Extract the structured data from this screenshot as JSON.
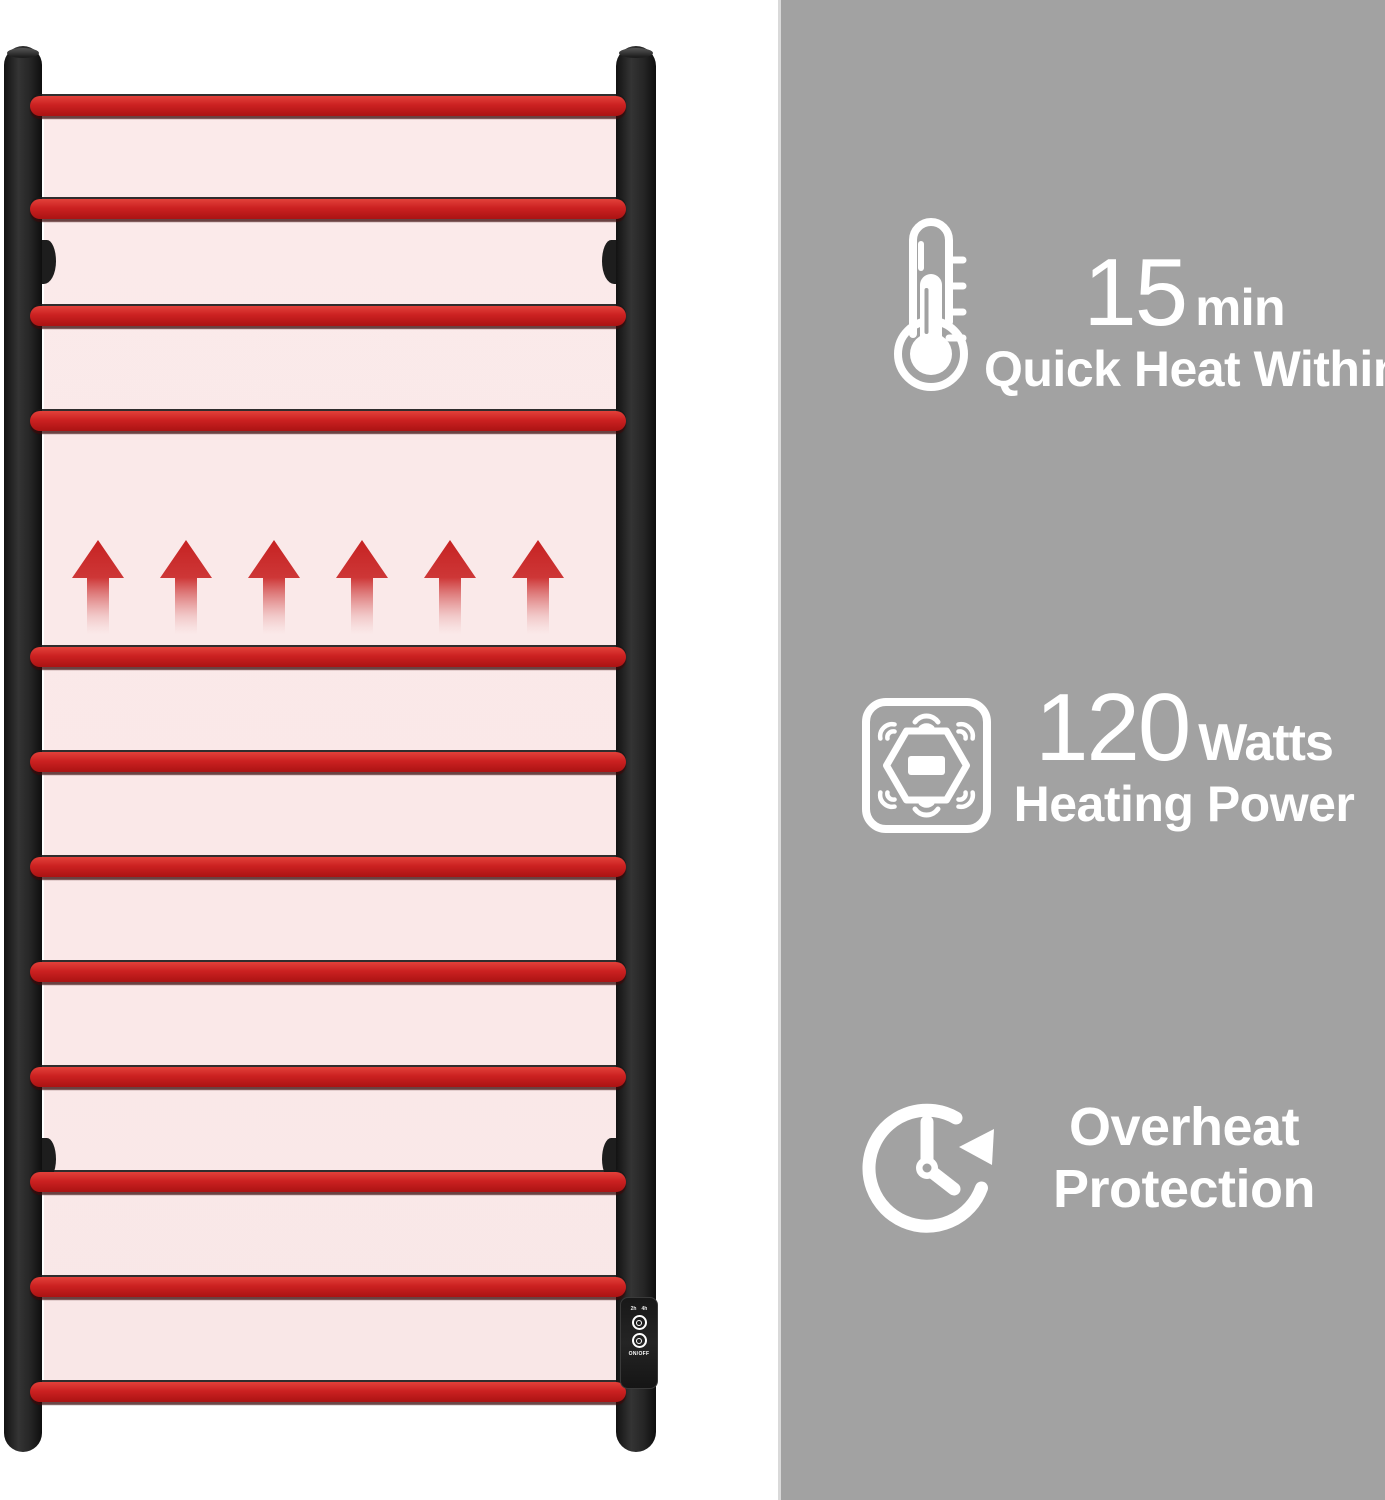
{
  "page": {
    "background": "#ffffff"
  },
  "right_panel": {
    "background": "#a2a2a2",
    "edge_color": "#d9d9d9",
    "text_color": "#ffffff"
  },
  "features": [
    {
      "icon": "thermometer-icon",
      "value": "15",
      "unit": "min",
      "lines": [
        "Quick Heat Within"
      ]
    },
    {
      "icon": "heating-power-sensor-icon",
      "value": "120",
      "unit": "Watts",
      "lines": [
        "Heating Power"
      ]
    },
    {
      "icon": "overheat-protection-clock-icon",
      "value": "",
      "unit": "",
      "lines": [
        "Overheat",
        "Protection"
      ]
    }
  ],
  "rack": {
    "bar_count": 12,
    "heat_arrow_count": 6,
    "bar_color": "#cb2121",
    "panel_color": "#fbeaea",
    "frame_color": "#1f1f1f",
    "arrow_color": "#c62222",
    "control_panel": {
      "timer_left": "2h",
      "timer_right": "4h",
      "power_label": "ON/OFF"
    }
  }
}
